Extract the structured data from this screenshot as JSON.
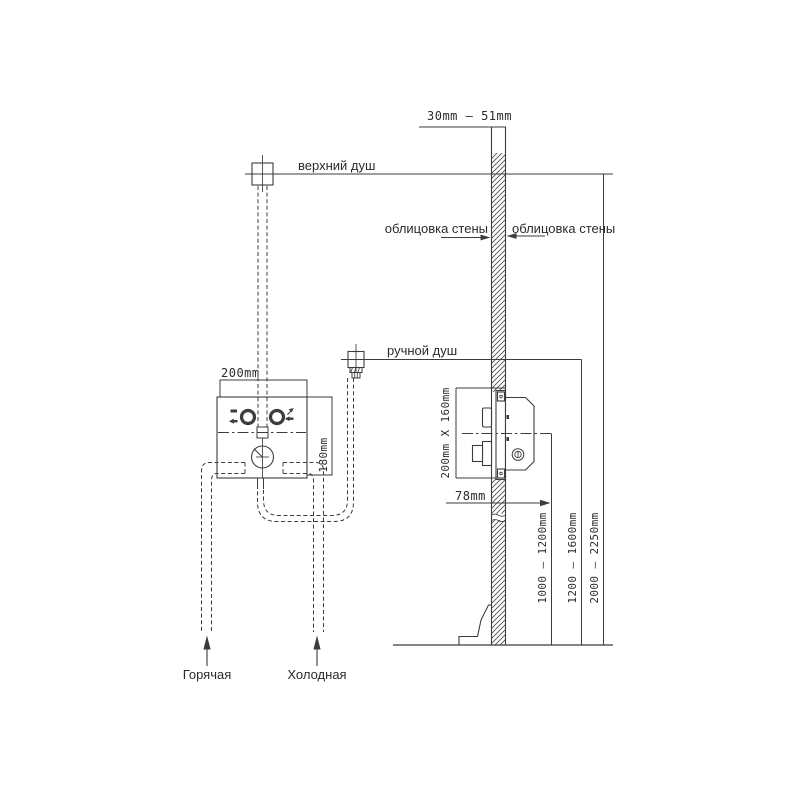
{
  "diagram": {
    "background": "#ffffff",
    "line_color": "#3c3c3c",
    "labels": {
      "overhead_shower": "верхний душ",
      "hand_shower": "ручной душ",
      "wall_cladding_left": "облицовка стены",
      "wall_cladding_right": "облицовка стены",
      "hot_supply": "Горячая",
      "cold_supply": "Холодная"
    },
    "dimensions": {
      "arm_depth_range": "30mm — 51mm",
      "box_width": "200mm",
      "box_height": "180mm",
      "rough_in_box": "200mm X 160mm",
      "box_depth": "78mm",
      "mixer_height_range": "1000 — 1200mm",
      "hand_shower_height_range": "1200 — 1600mm",
      "overhead_height_range": "2000 — 2250mm"
    }
  }
}
